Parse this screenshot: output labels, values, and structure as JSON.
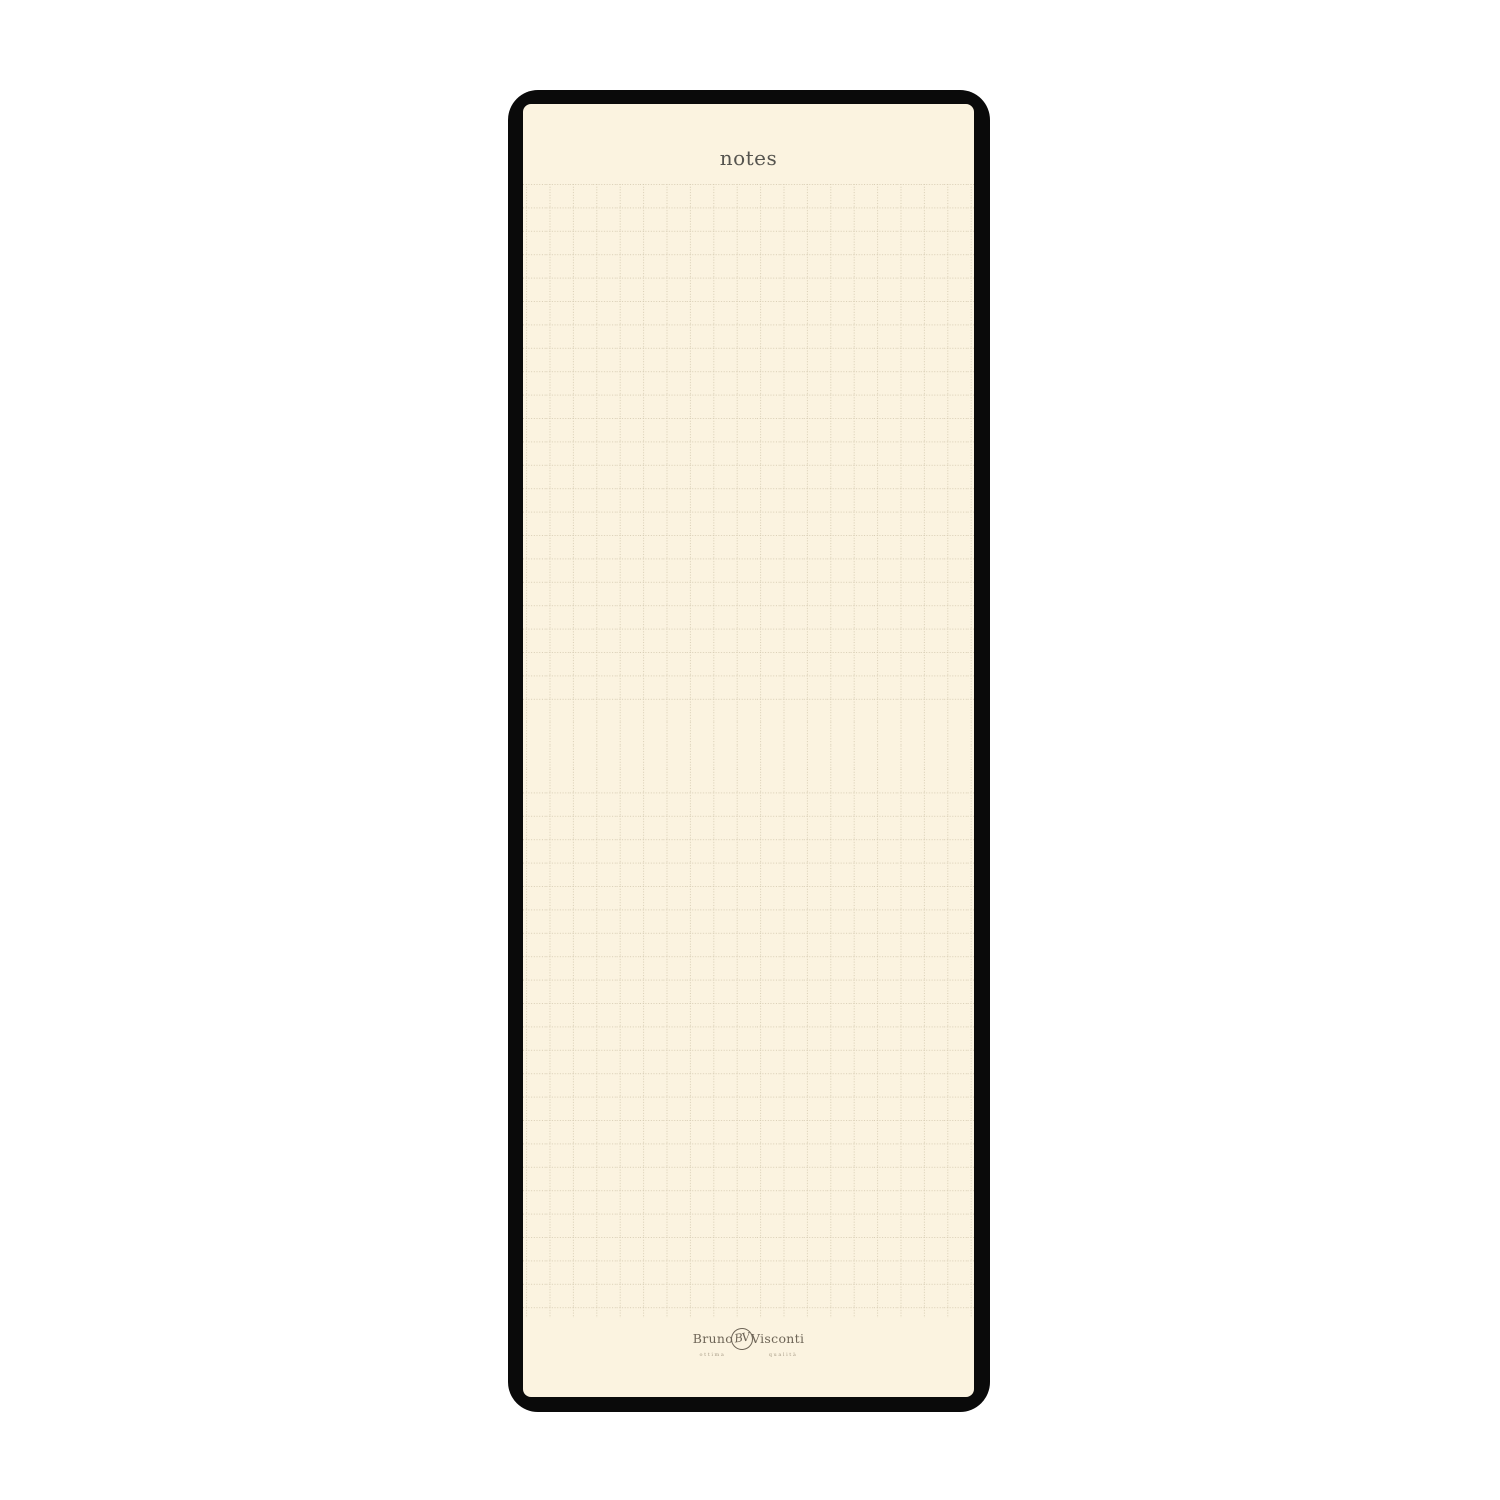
{
  "notepad": {
    "title": "notes",
    "colors": {
      "cover": "#0a0a0a",
      "paper": "#fbf3e0",
      "grid_line": "#d8cdb4",
      "title_text": "#55544f",
      "brand_text": "#6e6557",
      "tagline_text": "#a89c87"
    },
    "brand": {
      "first": "Bruno",
      "monogram": "BV",
      "last": "Visconti",
      "tagline_first": "ottima",
      "tagline_last": "qualità"
    }
  }
}
